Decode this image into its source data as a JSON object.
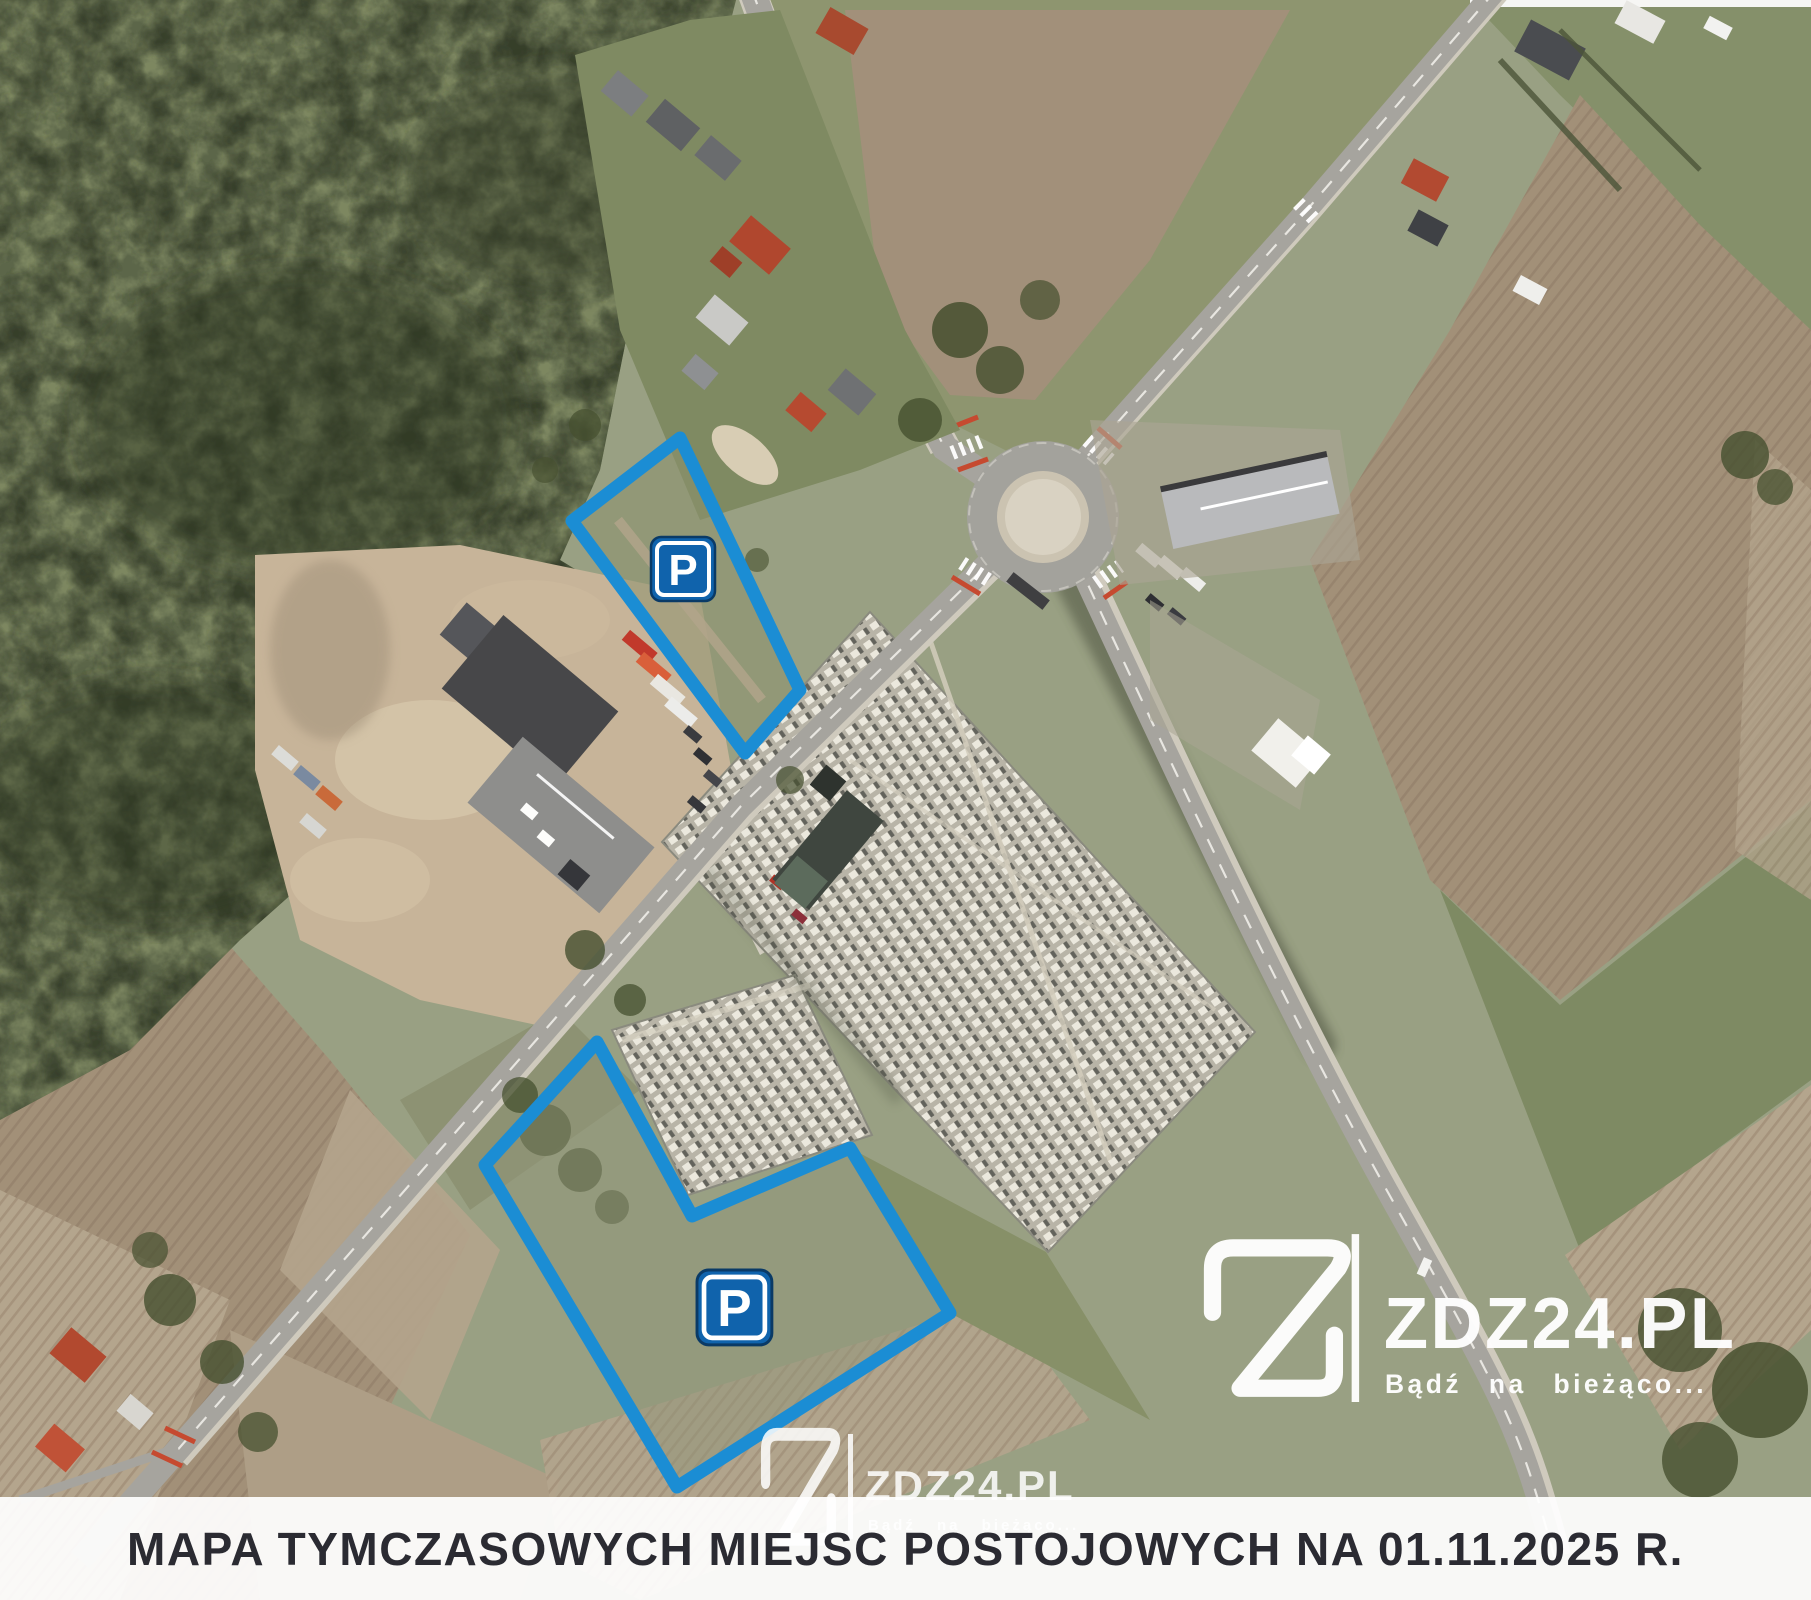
{
  "banner": {
    "title": "MAPA TYMCZASOWYCH MIEJSC POSTOJOWYCH NA 01.11.2025 R."
  },
  "brand": {
    "name": "ZDZ24.PL",
    "tagline": "Bądź na bieżąco..."
  },
  "parking": {
    "sign_label": "P",
    "zones": [
      {
        "name": "temporary-parking-zone-north",
        "points": "572,521 680,438 800,690 745,753",
        "sign_transform": "translate(651,537) scale(1)"
      },
      {
        "name": "temporary-parking-zone-south",
        "points": "597,1042 692,1216 850,1148 950,1313 677,1487 485,1165",
        "sign_transform": "translate(697,1270) scale(1.17)"
      }
    ]
  },
  "colors": {
    "accent": "#1b8dd4",
    "sign_fill": "#1063ac",
    "sign_border": "#0a3a66",
    "banner_bg": "rgba(255,255,255,0.93)",
    "banner_text": "#2b2b32",
    "watermark": "#ffffff"
  }
}
